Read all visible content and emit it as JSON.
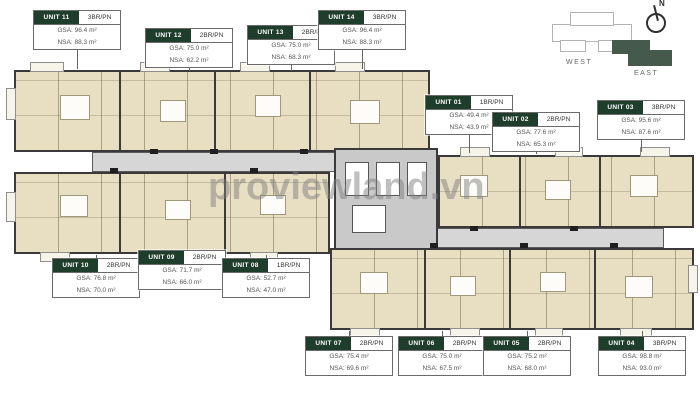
{
  "watermark": {
    "text": "proviewland.vn"
  },
  "compass": {
    "north": "N",
    "west": "WEST",
    "east": "EAST"
  },
  "units": {
    "u11": {
      "id": "UNIT 11",
      "type": "3BR/PN",
      "gsa": "GSA: 96.4 m²",
      "nsa": "NSA: 88.3 m²"
    },
    "u12": {
      "id": "UNIT 12",
      "type": "2BR/PN",
      "gsa": "GSA: 75.0 m²",
      "nsa": "NSA: 62.2 m²"
    },
    "u13": {
      "id": "UNIT 13",
      "type": "2BR/PN",
      "gsa": "GSA: 75.0 m²",
      "nsa": "NSA: 68.3 m²"
    },
    "u14": {
      "id": "UNIT 14",
      "type": "3BR/PN",
      "gsa": "GSA: 96.4 m²",
      "nsa": "NSA: 88.3 m²"
    },
    "u01": {
      "id": "UNIT 01",
      "type": "1BR/PN",
      "gsa": "GSA: 49.4 m²",
      "nsa": "NSA: 43.9 m²"
    },
    "u02": {
      "id": "UNIT 02",
      "type": "2BR/PN",
      "gsa": "GSA: 77.6 m²",
      "nsa": "NSA: 65.3 m²"
    },
    "u03": {
      "id": "UNIT 03",
      "type": "3BR/PN",
      "gsa": "GSA: 95.6 m²",
      "nsa": "NSA: 87.6 m²"
    },
    "u10": {
      "id": "UNIT 10",
      "type": "2BR/PN",
      "gsa": "GSA: 76.8 m²",
      "nsa": "NSA: 70.0 m²"
    },
    "u09": {
      "id": "UNIT 09",
      "type": "2BR/PN",
      "gsa": "GSA: 71.7 m²",
      "nsa": "NSA: 66.0 m²"
    },
    "u08": {
      "id": "UNIT 08",
      "type": "1BR/PN",
      "gsa": "GSA: 52.7 m²",
      "nsa": "NSA: 47.0 m²"
    },
    "u07": {
      "id": "UNIT 07",
      "type": "2BR/PN",
      "gsa": "GSA: 75.4 m²",
      "nsa": "NSA: 69.6 m²"
    },
    "u06": {
      "id": "UNIT 06",
      "type": "2BR/PN",
      "gsa": "GSA: 75.0 m²",
      "nsa": "NSA: 67.5 m²"
    },
    "u05": {
      "id": "UNIT 05",
      "type": "2BR/PN",
      "gsa": "GSA: 75.2 m²",
      "nsa": "NSA: 68.0 m²"
    },
    "u04": {
      "id": "UNIT 04",
      "type": "3BR/PN",
      "gsa": "GSA: 98.8 m²",
      "nsa": "NSA: 93.0 m²"
    }
  }
}
